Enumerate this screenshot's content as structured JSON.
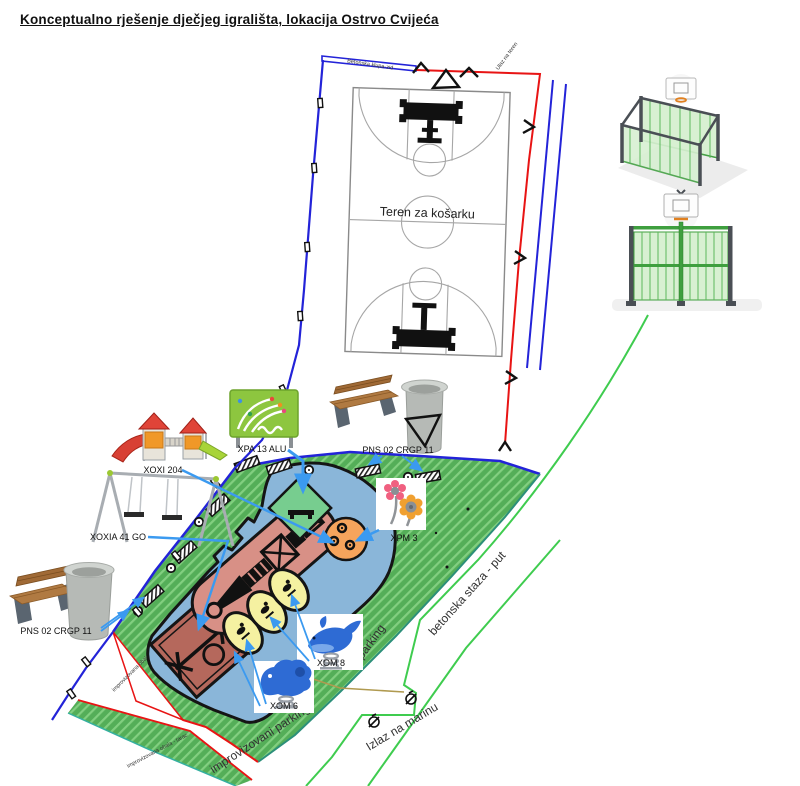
{
  "title": "Konceptualno rješenje dječjeg igrališta, lokacija Ostrvo Cvijeća",
  "court": {
    "label": "Teren za košarku"
  },
  "boundaries": {
    "wall_label": "Betonska klupa-zid",
    "entrance_label": "Ulaz na teren"
  },
  "areas": {
    "parking": "parking",
    "concrete_path": "betonska staza - put",
    "improvised_parking": "improvizovani parking",
    "marina_exit": "Izlaz na marinu",
    "improvised_shore": "improvizovana obala - tarac"
  },
  "equipment": {
    "tower": {
      "label": "XOXI 204"
    },
    "swing": {
      "label": "XOXIA 41 GO"
    },
    "panel": {
      "label": "XPA 13 ALU"
    },
    "bench_set_top": {
      "label": "PNS 02 CRGP 11"
    },
    "bench_set_left": {
      "label": "PNS 02 CRGP 11"
    },
    "spinner": {
      "label": "XPM 3"
    },
    "rider_large": {
      "label": "XOM 8"
    },
    "rider_small": {
      "label": "XOM 6"
    }
  },
  "colors": {
    "grass": "#54ae58",
    "grass_hatch": "#82cf80",
    "pond": "#8ab6d9",
    "structure_zone": "#d89086",
    "swing_zone": "#b5685c",
    "rider_oval": "#f5f1a1",
    "spinner_circle": "#f6a45c",
    "panel_zone": "#77cd8f",
    "fence_blue": "#2323d8",
    "boundary_red": "#e81414",
    "path_green": "#3fcc4f",
    "leader_blue": "#3b9af0"
  }
}
